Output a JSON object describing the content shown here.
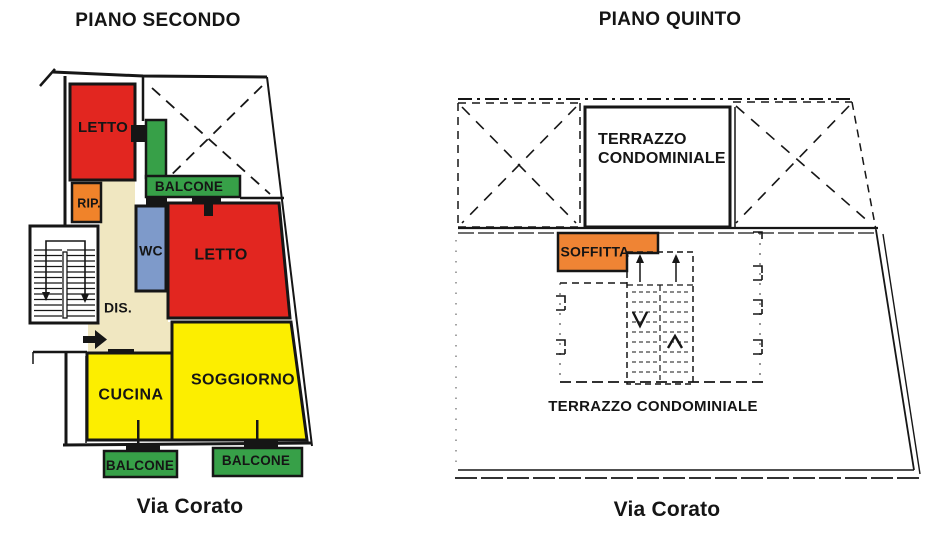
{
  "left_plan": {
    "title": "PIANO SECONDO",
    "street": "Via Corato",
    "rooms": {
      "letto1": {
        "label": "LETTO",
        "color": "#e22620"
      },
      "balcone_top": {
        "label": "BALCONE",
        "color": "#37a048"
      },
      "rip": {
        "label": "RIP.",
        "color": "#f0832a"
      },
      "wc": {
        "label": "WC",
        "color": "#7e9aca"
      },
      "letto2": {
        "label": "LETTO",
        "color": "#e22620"
      },
      "dis": {
        "label": "DIS.",
        "color": "#f0e7c1"
      },
      "cucina": {
        "label": "CUCINA",
        "color": "#fcee00"
      },
      "soggiorno": {
        "label": "SOGGIORNO",
        "color": "#fcee00"
      },
      "balcone_sx": {
        "label": "BALCONE",
        "color": "#37a048"
      },
      "balcone_dx": {
        "label": "BALCONE",
        "color": "#37a048"
      }
    }
  },
  "right_plan": {
    "title": "PIANO QUINTO",
    "street": "Via Corato",
    "areas": {
      "terrazzo_top": {
        "label_line1": "TERRAZZO",
        "label_line2": "CONDOMINIALE"
      },
      "soffitta": {
        "label": "SOFFITTA",
        "color": "#ef8434"
      },
      "terrazzo_bottom": {
        "label": "TERRAZZO CONDOMINIALE"
      }
    }
  },
  "colors": {
    "walls": "#161616",
    "paper": "#ffffff"
  }
}
